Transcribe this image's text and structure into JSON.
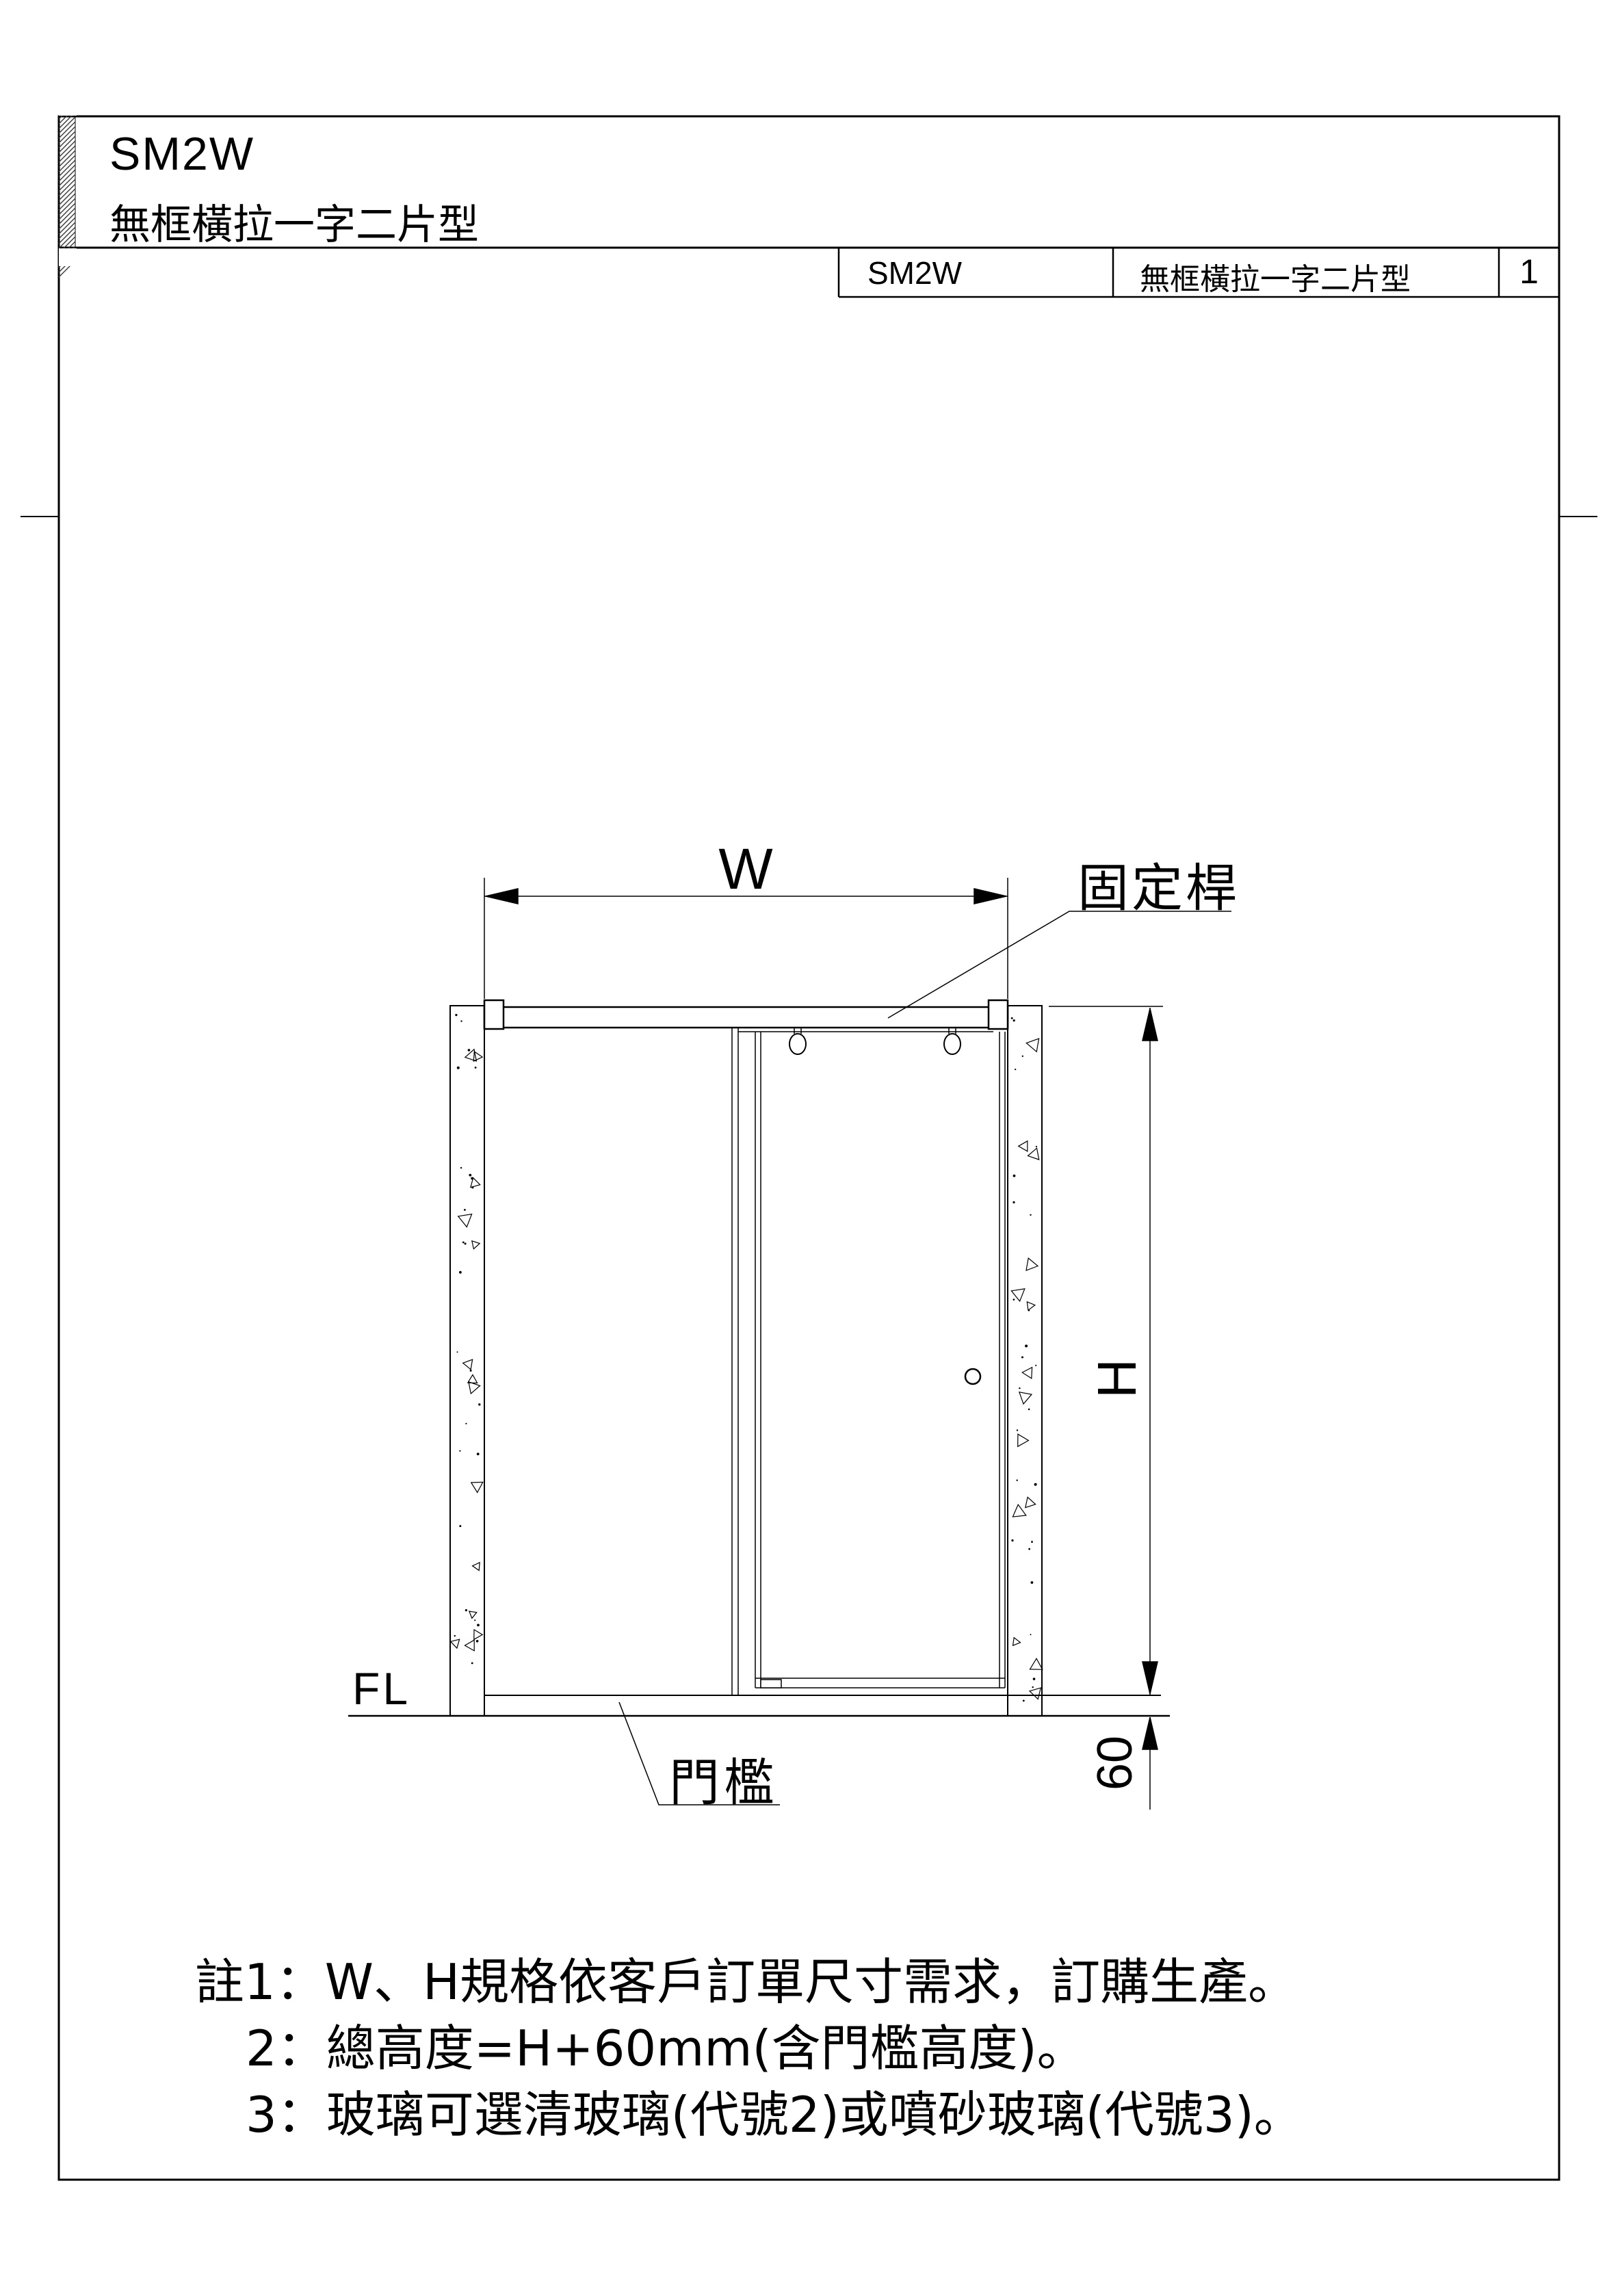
{
  "header": {
    "model": "SM2W",
    "type_name": "無框橫拉一字二片型"
  },
  "title_block": {
    "model": "SM2W",
    "type_name": "無框橫拉一字二片型",
    "page_number": "1"
  },
  "drawing": {
    "width_dim_label": "W",
    "height_dim_label": "H",
    "threshold_height_dim": "60",
    "fixed_bar_callout": "固定桿",
    "threshold_callout": "門檻",
    "floor_level_label": "FL"
  },
  "notes": {
    "line1": "註1：W、H規格依客戶訂單尺寸需求，訂購生產。",
    "line2": "2：總高度=H+60mm(含門檻高度)。",
    "line3": "3：玻璃可選清玻璃(代號2)或噴砂玻璃(代號3)。"
  },
  "colors": {
    "ink": "#000000",
    "paper": "#ffffff"
  }
}
